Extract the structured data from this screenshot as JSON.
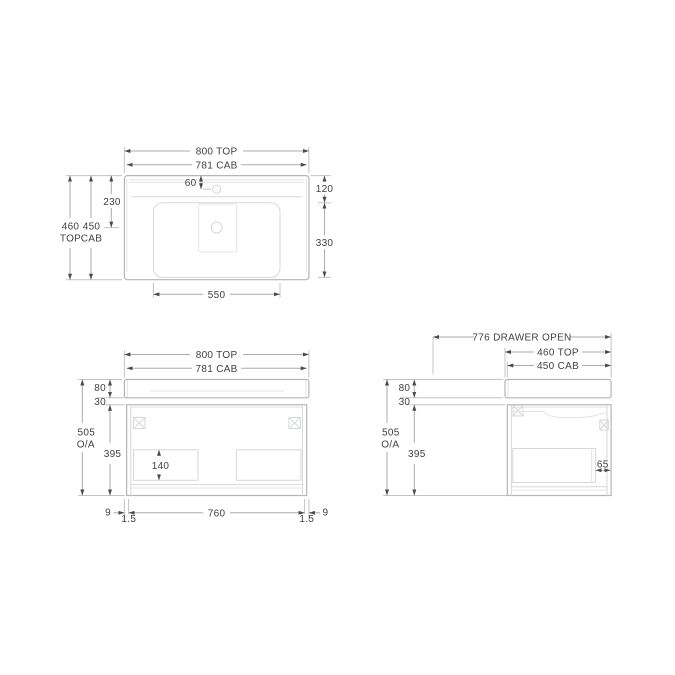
{
  "drawing_type": "vanity-unit-dimension-drawing",
  "colors": {
    "background": "#ffffff",
    "text": "#414141",
    "arrow": "#4a4a4a",
    "line_object": "#b3b6b8",
    "line_detail": "#d6d8d9",
    "line_faint": "#e4e5e6",
    "line_dim": "#a9abad"
  },
  "top_view": {
    "width_top": "800 TOP",
    "width_cab": "781 CAB",
    "faucet_offset": "60",
    "drain_offset": "230",
    "depth_total_value": "460",
    "depth_total_unit": "TOP",
    "depth_cab_value": "450",
    "depth_cab_unit": "CAB",
    "back_to_basin": "120",
    "basin_depth": "330",
    "basin_width": "550"
  },
  "front_view": {
    "width_top": "800 TOP",
    "width_cab": "781 CAB",
    "top_thickness": "80",
    "top_gap": "30",
    "overall_value": "505",
    "overall_unit": "O/A",
    "cab_height": "395",
    "drawer_internal": "140",
    "side_gap_left": "9",
    "reveal_left": "1.5",
    "drawer_front_width": "760",
    "reveal_right": "1.5",
    "side_gap_right": "9"
  },
  "side_view": {
    "drawer_open": "776 DRAWER OPEN",
    "depth_top": "460 TOP",
    "depth_cab": "450 CAB",
    "top_thickness": "80",
    "top_gap": "30",
    "overall_value": "505",
    "overall_unit": "O/A",
    "cab_height": "395",
    "drawer_back_gap": "65"
  }
}
